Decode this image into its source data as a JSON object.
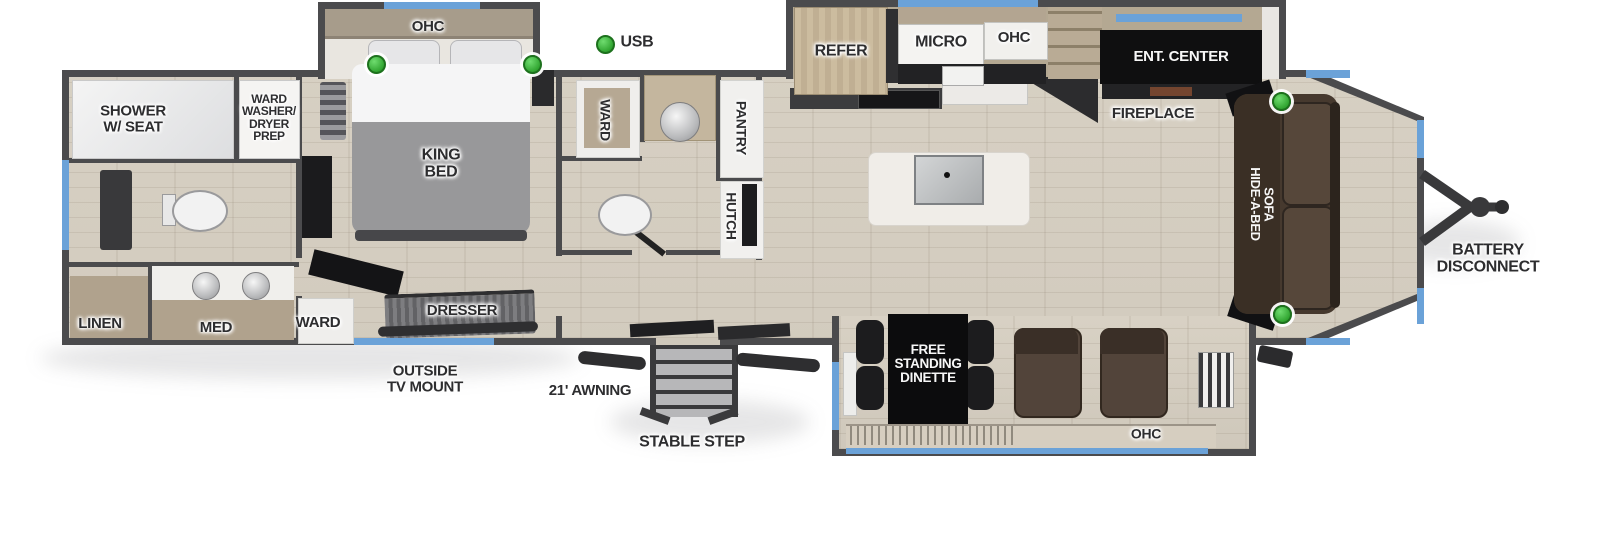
{
  "legend": {
    "usb": "USB"
  },
  "rear_bath": {
    "shower": "SHOWER\nW/ SEAT",
    "ward_washer_dryer": "WARD\nWASHER/\nDRYER\nPREP",
    "linen": "LINEN",
    "med": "MED"
  },
  "bedroom": {
    "ohc": "OHC",
    "king_bed": "KING\nBED",
    "dresser": "DRESSER",
    "ward": "WARD"
  },
  "mid_bath": {
    "ward": "WARD",
    "pantry": "PANTRY",
    "hutch": "HUTCH"
  },
  "kitchen": {
    "refer": "REFER",
    "micro": "MICRO",
    "ohc": "OHC",
    "ent_center": "ENT. CENTER",
    "fireplace": "FIREPLACE"
  },
  "living": {
    "sofa": "HIDE-A-BED\nSOFA",
    "dinette": "FREE\nSTANDING\nDINETTE",
    "ohc": "OHC"
  },
  "exterior": {
    "battery_disconnect": "BATTERY\nDISCONNECT",
    "outside_tv_mount": "OUTSIDE\nTV MOUNT",
    "awning": "21' AWNING",
    "stable_step": "STABLE STEP"
  },
  "colors": {
    "wall": "#4b4b4d",
    "floor": "#d3ccbf",
    "window_accent": "#6ba2d8",
    "usb_indicator": "#3ec13e",
    "cabinet_tan": "#b0a28d",
    "appliance_black": "#111112",
    "sofa_brown": "#46392e",
    "label_text": "#2d2d2f"
  }
}
